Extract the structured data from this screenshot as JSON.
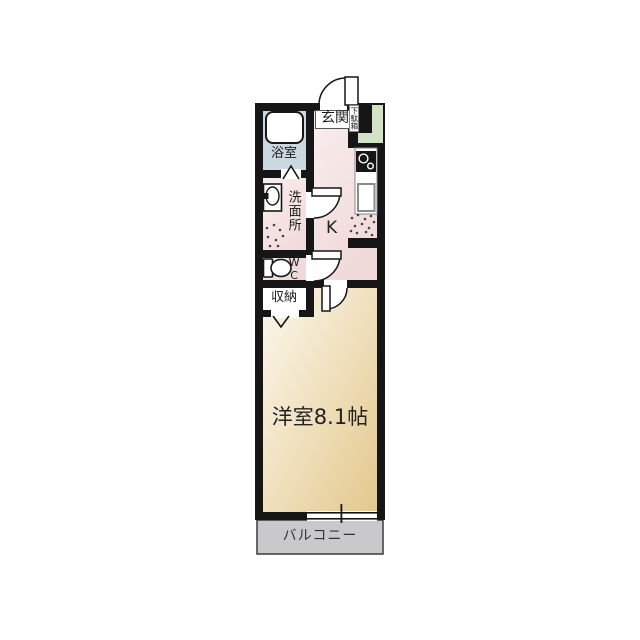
{
  "floorplan": {
    "labels": {
      "genkan": "玄関",
      "getabako": "下駄箱",
      "bathroom": "浴室",
      "washroom": "洗面所",
      "wc": "WC",
      "storage": "収納",
      "kitchen": "K",
      "main_room": "洋室8.1帖",
      "balcony": "バルコニー"
    },
    "colors": {
      "wall": "#161616",
      "bathroom_floor": "#ccd8e0",
      "hall_floor_light": "#f9eeee",
      "hall_floor": "#f0d9d9",
      "shoe_cabinet": "#d2e2c4",
      "room_floor_light": "#fcf8ee",
      "room_floor_dark": "#e3c88d",
      "closet_floor": "#ffffff",
      "balcony_floor": "#c9c9cb",
      "background": "#ffffff"
    },
    "icons": {
      "bathtub": "rounded-rectangle",
      "washbasin": "oval-in-rectangle",
      "toilet": "tank-and-bowl",
      "stove": "two-burner-circles",
      "kitchen_sink": "rectangle",
      "appliance_space": "dotted-area",
      "swing_door": "quarter-arc",
      "folding_door": "v-mark",
      "bath_door": "chevron-mark",
      "window": "double-line"
    }
  }
}
